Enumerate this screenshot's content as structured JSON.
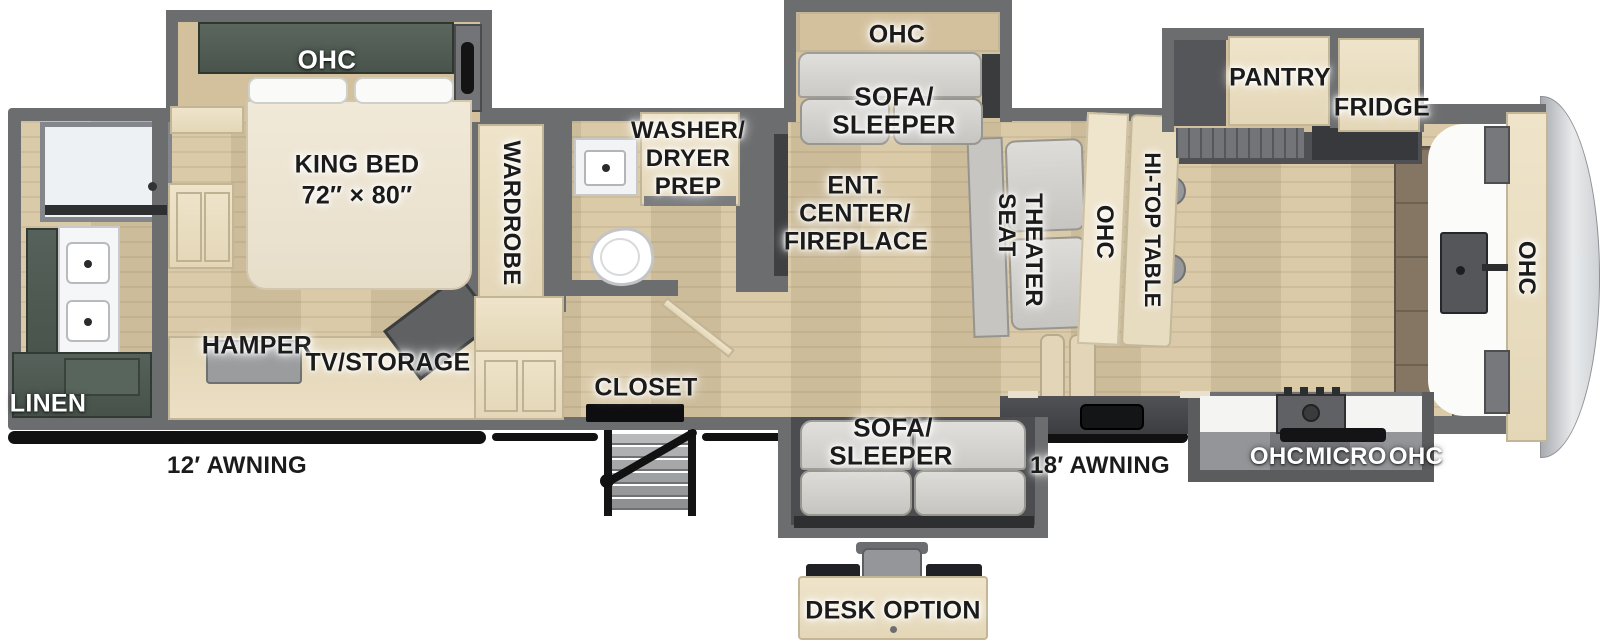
{
  "labels": {
    "ohc_bed": "OHC",
    "king_bed_1": "KING BED",
    "king_bed_2": "72″ × 80″",
    "wardrobe": "WARDROBE",
    "washer_1": "WASHER/",
    "washer_2": "DRYER",
    "washer_3": "PREP",
    "ohc_sofa_top": "OHC",
    "sofa_top_1": "SOFA/",
    "sofa_top_2": "SLEEPER",
    "ent_1": "ENT.",
    "ent_2": "CENTER/",
    "ent_3": "FIREPLACE",
    "theater_1": "THEATER",
    "theater_2": "SEAT",
    "ohc_island": "OHC",
    "hitop_table": "HI-TOP TABLE",
    "pantry": "PANTRY",
    "fridge": "FRIDGE",
    "ohc_front": "OHC",
    "kitchen_ohc_left": "OHC",
    "kitchen_micro": "MICRO",
    "kitchen_ohc_right": "OHC",
    "awning_18": "18′ AWNING",
    "sofa_bottom_1": "SOFA/",
    "sofa_bottom_2": "SLEEPER",
    "desk_option": "DESK OPTION",
    "closet": "CLOSET",
    "hamper": "HAMPER",
    "tv_storage": "TV/STORAGE",
    "linen": "LINEN",
    "awning_12": "12′ AWNING"
  },
  "colors": {
    "wall_gray": "#6c6d6f",
    "floor_wood": "#d7c6a2",
    "cabinet_wood": "#e9ddc2",
    "cabinet_green": "#4d584f",
    "sofa_gray": "#d6d5d1",
    "counter_dark": "#4a4b4e",
    "awning_black": "#111111",
    "label_black": "#1b1b1b",
    "label_white": "#ffffff"
  }
}
